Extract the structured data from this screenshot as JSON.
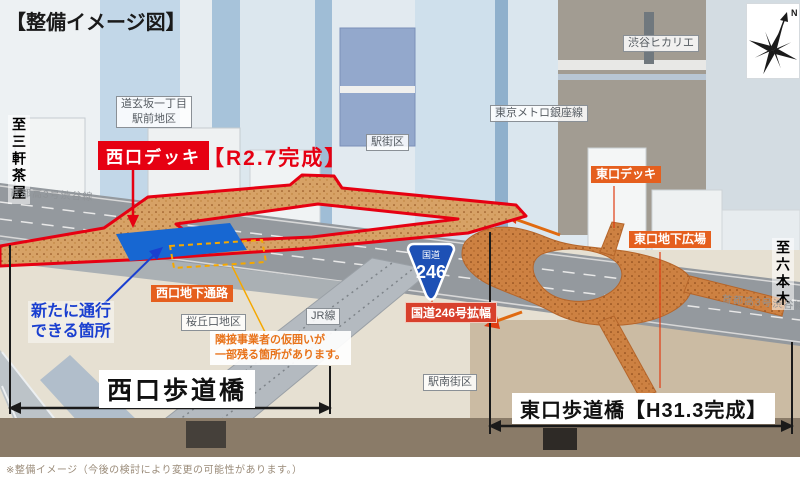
{
  "title": "【整備イメージ図】",
  "areas": {
    "dogenzaka": {
      "line1": "道玄坂一丁目",
      "line2": "駅前地区"
    },
    "ekigaiku": "駅街区",
    "ginza_line": "東京メトロ銀座線",
    "hikarie": "渋谷ヒカリエ",
    "sakuragaoka": "桜丘口地区",
    "jr_line": "JR線",
    "ekinan": "駅南街区"
  },
  "deck_labels": {
    "west_deck": "西口デッキ",
    "west_deck_completion": "【R2.7完成】",
    "east_deck": "東口デッキ",
    "east_underground_plaza": "東口地下広場",
    "west_underground_passage": "西口地下通路",
    "route246_widening": "国道246号拡幅"
  },
  "annotations": {
    "new_passage": {
      "line1": "新たに通行",
      "line2": "できる箇所"
    },
    "temporary_fence": {
      "line1": "隣接事業者の仮囲いが",
      "line2": "一部残る箇所があります。"
    }
  },
  "directions": {
    "to_sangenjaya": "至三軒茶屋",
    "to_roppongi": "至六本木",
    "shutoko_left": "首都高3号渋谷線",
    "shutoko_right": "首都高3号渋谷線"
  },
  "bridges": {
    "west_bridge": "西口歩道橋",
    "east_bridge": "東口歩道橋【H31.3完成】"
  },
  "route_sign": {
    "prefix": "国道",
    "number": "246"
  },
  "compass": {
    "north": "N"
  },
  "footnote": "※整備イメージ（今後の検討により変更の可能性があります。）",
  "colors": {
    "accent_red": "#e60012",
    "deck_orange_west": "#d7a266",
    "deck_orange_east": "#cd8142",
    "label_orange": "#e55f1e",
    "highlight_blue": "#1767d2",
    "dashed_yellow": "#f5a800",
    "route_sign_blue": "#1d50b5",
    "ground_brown": "#8a7b68"
  }
}
